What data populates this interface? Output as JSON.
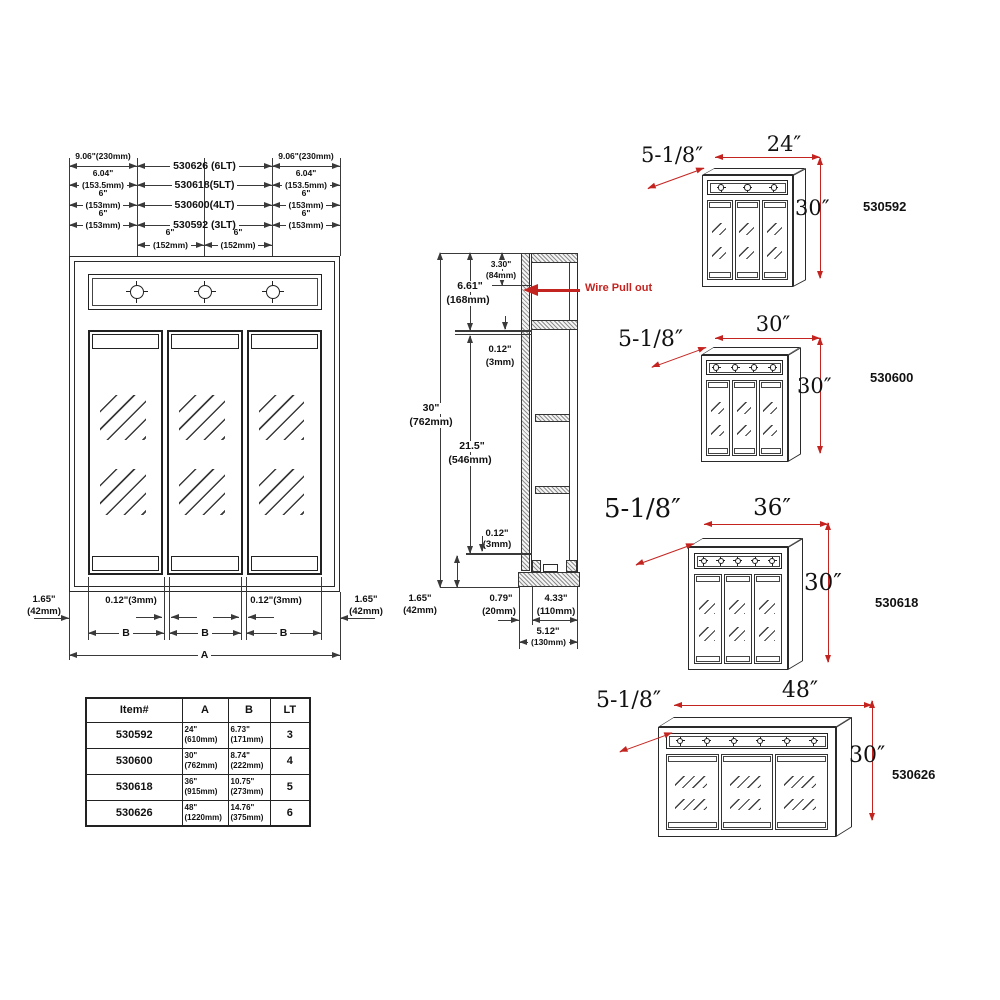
{
  "drawing": {
    "top_dims": {
      "r1": {
        "side": "9.06\"(230mm)",
        "center": "530626 (6LT)"
      },
      "r2": {
        "side_in": "6.04\"",
        "side_mm": "(153.5mm)",
        "center": "530618(5LT)"
      },
      "r3": {
        "side_in": "6\"",
        "side_mm": "(153mm)",
        "center": "530600(4LT)"
      },
      "r4": {
        "side_in": "6\"",
        "side_mm": "(153mm)",
        "center": "530592 (3LT)"
      },
      "r5": {
        "in": "6\"",
        "mm": "(152mm)"
      }
    },
    "bottom_dims": {
      "margin_in": "1.65\"",
      "margin_mm": "(42mm)",
      "gap": "0.12\"(3mm)",
      "door": "B",
      "overall": "A"
    },
    "lights": 3,
    "doors": 3
  },
  "section": {
    "d330_in": "3.30\"",
    "d330_mm": "(84mm)",
    "d661_in": "6.61\"",
    "d661_mm": "(168mm)",
    "d012_in": "0.12\"",
    "d012_mm": "(3mm)",
    "d30_in": "30\"",
    "d30_mm": "(762mm)",
    "d215_in": "21.5\"",
    "d215_mm": "(546mm)",
    "d165_in": "1.65\"",
    "d165_mm": "(42mm)",
    "d079_in": "0.79\"",
    "d079_mm": "(20mm)",
    "d433_in": "4.33\"",
    "d433_mm": "(110mm)",
    "d512_in": "5.12\"",
    "d512_mm": "(130mm)",
    "wire_label": "Wire Pull out"
  },
  "cabinets": [
    {
      "id": "530592",
      "width": "24″",
      "height": "30″",
      "depth": "5-1/8″",
      "lights": 3,
      "doors": 3
    },
    {
      "id": "530600",
      "width": "30″",
      "height": "30″",
      "depth": "5-1/8″",
      "lights": 4,
      "doors": 3
    },
    {
      "id": "530618",
      "width": "36″",
      "height": "30″",
      "depth": "5-1/8″",
      "lights": 5,
      "doors": 3
    },
    {
      "id": "530626",
      "width": "48″",
      "height": "30″",
      "depth": "5-1/8″",
      "lights": 6,
      "doors": 3
    }
  ],
  "table": {
    "headers": [
      "Item#",
      "A",
      "B",
      "LT"
    ],
    "rows": [
      {
        "item": "530592",
        "a_in": "24\"",
        "a_mm": "(610mm)",
        "b_in": "6.73\"",
        "b_mm": "(171mm)",
        "lt": "3"
      },
      {
        "item": "530600",
        "a_in": "30\"",
        "a_mm": "(762mm)",
        "b_in": "8.74\"",
        "b_mm": "(222mm)",
        "lt": "4"
      },
      {
        "item": "530618",
        "a_in": "36\"",
        "a_mm": "(915mm)",
        "b_in": "10.75\"",
        "b_mm": "(273mm)",
        "lt": "5"
      },
      {
        "item": "530626",
        "a_in": "48\"",
        "a_mm": "(1220mm)",
        "b_in": "14.76\"",
        "b_mm": "(375mm)",
        "lt": "6"
      }
    ]
  },
  "colors": {
    "line": "#3a3a3a",
    "accent_red": "#c42420"
  }
}
